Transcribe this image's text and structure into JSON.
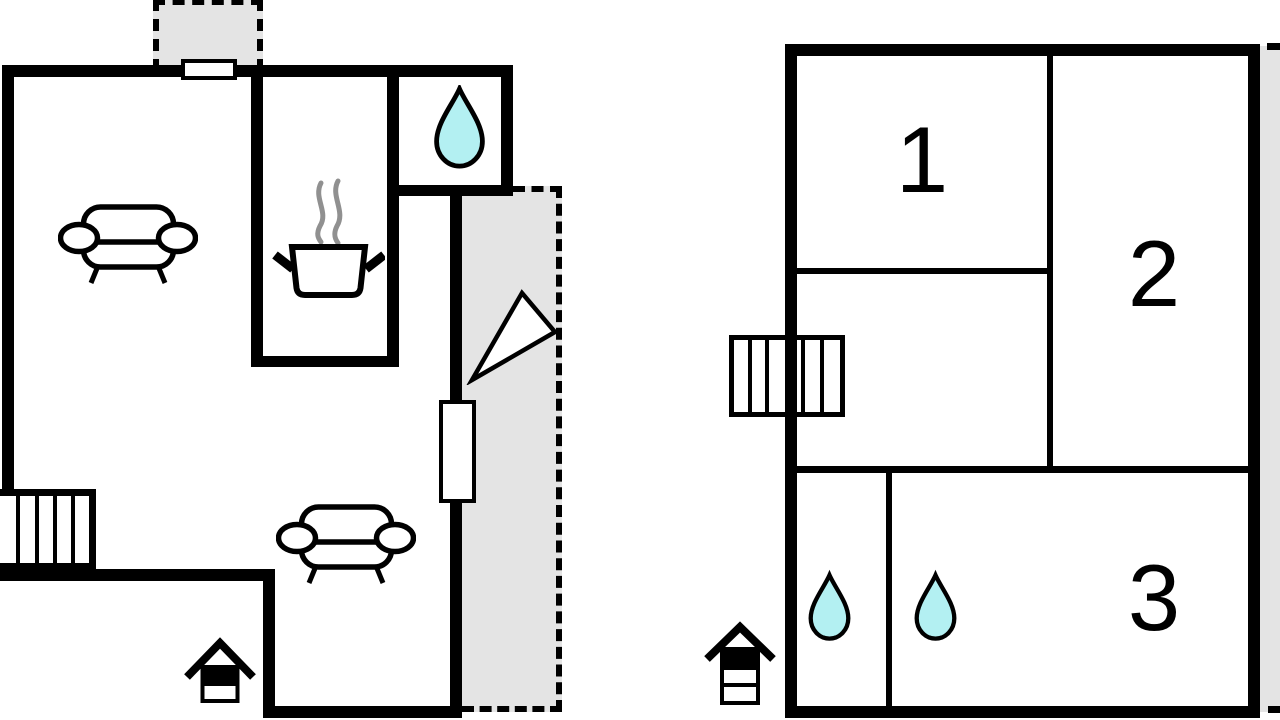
{
  "plan_type": "floor-plan",
  "rooms": [
    {
      "label": "1"
    },
    {
      "label": "2"
    },
    {
      "label": "3"
    }
  ],
  "colors": {
    "wall": "#000000",
    "outdoor_area": "#e4e4e4",
    "water_drop": "#b3f0f2",
    "steam": "#909090",
    "background": "#ffffff"
  },
  "icons": {
    "water_drop": "water-drop-icon",
    "sofa": "sofa-icon",
    "cooking_pot": "cooking-pot-icon",
    "stairs": "stairs-icon",
    "entrance": "entrance-house-icon",
    "door_swing": "door-swing-icon",
    "window": "window-icon"
  }
}
